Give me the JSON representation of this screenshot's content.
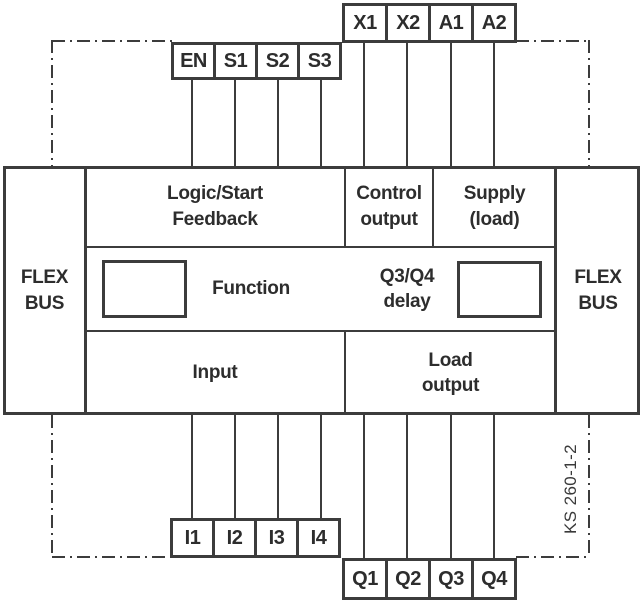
{
  "palette": {
    "line_color": "#3c3c3c",
    "text_color": "#2d2d2d",
    "background": "#ffffff"
  },
  "terminals": {
    "top_outer": [
      "X1",
      "X2",
      "A1",
      "A2"
    ],
    "top_inner": [
      "EN",
      "S1",
      "S2",
      "S3"
    ],
    "bottom_inner": [
      "I1",
      "I2",
      "I3",
      "I4"
    ],
    "bottom_outer": [
      "Q1",
      "Q2",
      "Q3",
      "Q4"
    ]
  },
  "blocks": {
    "flex_bus_left": "FLEX\nBUS",
    "flex_bus_right": "FLEX\nBUS",
    "logic_start_feedback": "Logic/Start\nFeedback",
    "control_output": "Control\noutput",
    "supply_load": "Supply\n(load)",
    "function_label": "Function",
    "q3_q4_delay": "Q3/Q4\ndelay",
    "input": "Input",
    "load_output": "Load\noutput"
  },
  "side_label": "KS 260-1-2"
}
